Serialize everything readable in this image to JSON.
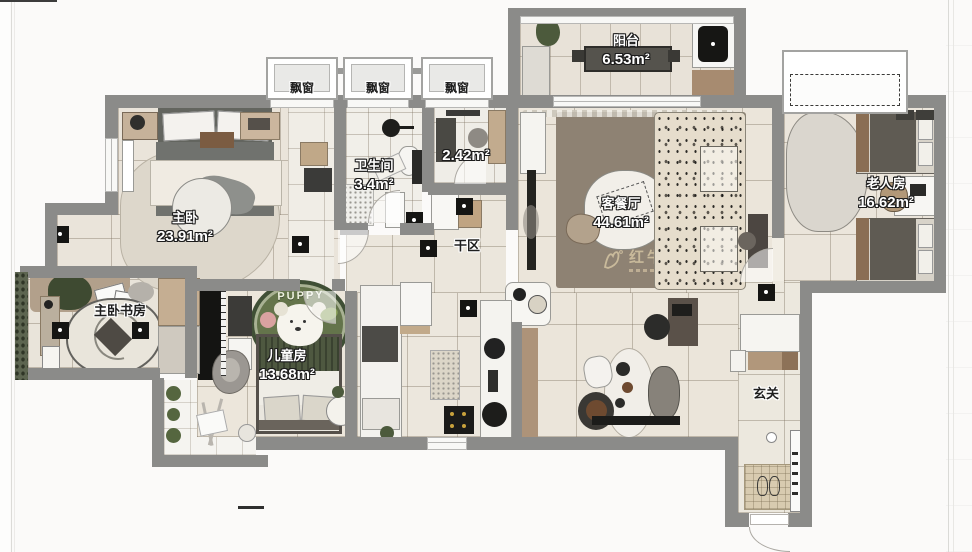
{
  "plan": {
    "type": "floor-plan",
    "watermark": {
      "brand": "红牛装饰"
    },
    "bay_window_label": "飘窗",
    "kids_rug_text": "PUPPY",
    "rooms": {
      "master_bedroom": {
        "name": "主卧",
        "area": "23.91m²"
      },
      "bathroom": {
        "name": "卫生间",
        "area": "3.4m²"
      },
      "storage": {
        "area": "2.42m²"
      },
      "dry_area": {
        "name": "干区"
      },
      "balcony": {
        "name": "阳台",
        "area": "6.53m²"
      },
      "living_dining": {
        "name": "客餐厅",
        "area": "44.61m²"
      },
      "elder_room": {
        "name": "老人房",
        "area": "16.62m²"
      },
      "master_study": {
        "name": "主卧书房"
      },
      "kids_room": {
        "name": "儿童房",
        "area": "13.68m²"
      },
      "entry": {
        "name": "玄关"
      }
    },
    "colors": {
      "wall": "#8b8b89",
      "floor": "#eae4da",
      "living_rug": "#8e8273",
      "kids_rug_green": "#5c6c45",
      "wood": "#b1977b",
      "watermark": "#cdbd9e"
    }
  }
}
